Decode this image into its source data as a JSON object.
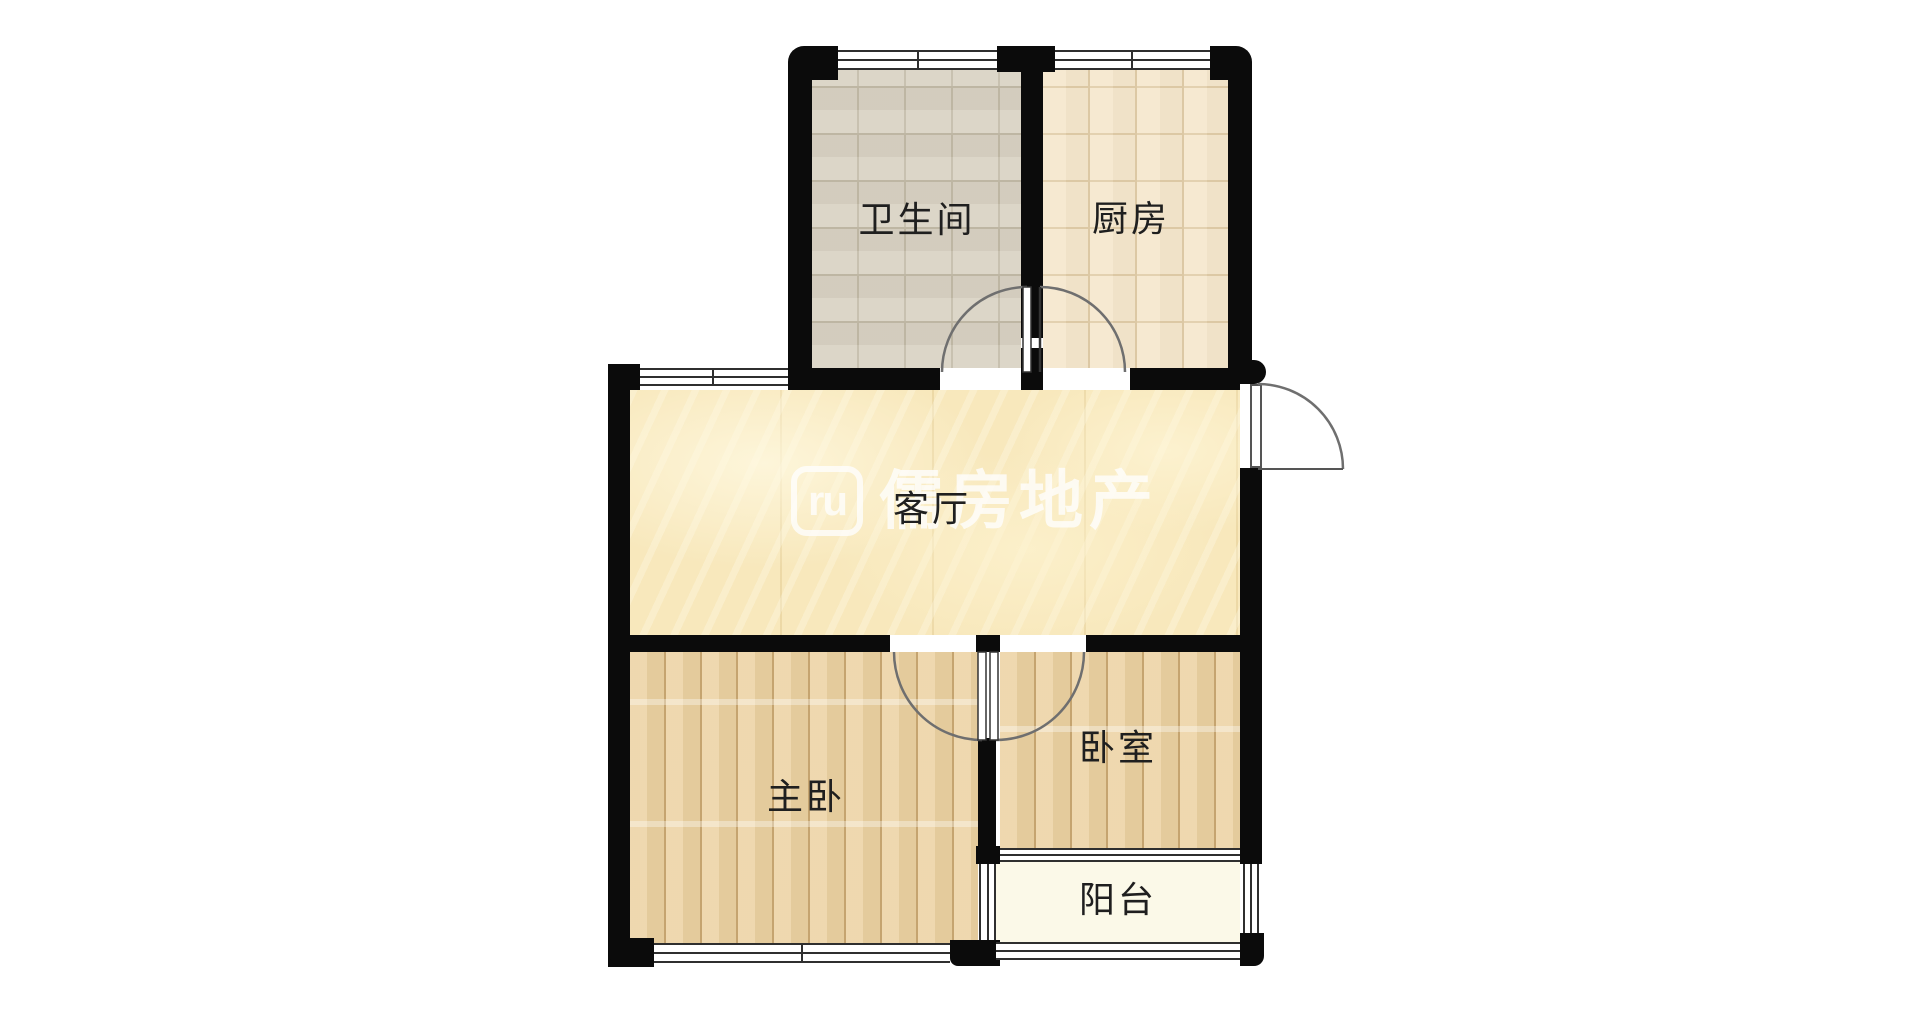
{
  "rooms": {
    "bathroom": {
      "label": "卫生间"
    },
    "kitchen": {
      "label": "厨房"
    },
    "living_room": {
      "label": "客厅"
    },
    "master_bedroom": {
      "label": "主卧"
    },
    "bedroom": {
      "label": "卧室"
    },
    "balcony": {
      "label": "阳台"
    }
  },
  "watermark": {
    "logo_text": "ru",
    "brand_text": "儒房地产"
  },
  "colors": {
    "background": "#ffffff",
    "wall": "#0b0b0b",
    "bathroom_floor": "#d8d1c2",
    "kitchen_floor": "#f5e7cc",
    "living_floor": "#f8e8bc",
    "wood_floor": "#ecd2a2",
    "balcony_floor": "#fbf9e8",
    "window_line": "#2f2f2f",
    "door_arc": "#6f6f6f",
    "label_text": "#1f1f1f",
    "watermark": "#ffffff"
  }
}
